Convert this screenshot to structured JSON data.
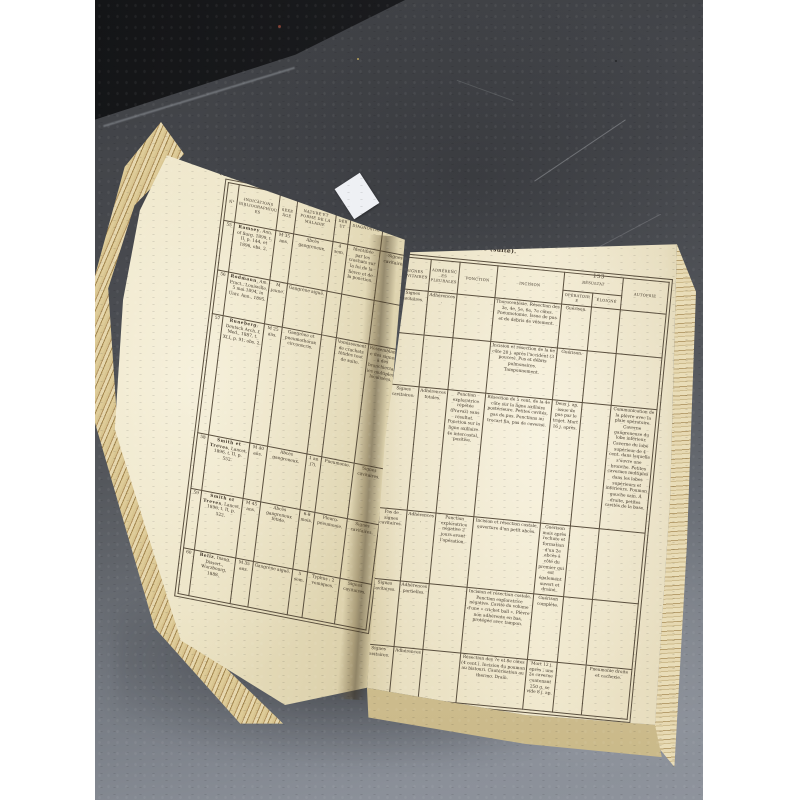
{
  "scene": {
    "description": "Antique medical book lying open on grey tiled floor, photographed from above",
    "colors": {
      "pillarbox": "#ffffff",
      "floor_dark": "#47494e",
      "floor_light": "#8b9099",
      "black_object": "#1b1c1e",
      "page_cream": "#ece3c5",
      "page_edge_tan": "#c9b281",
      "print_ink": "#3c3226",
      "bookmark_white": "#eef0f4"
    }
  },
  "book": {
    "bookmark_label": "",
    "left_page": {
      "page_number": "152",
      "side_label": "Tableau X.",
      "table": {
        "headers": [
          "N°",
          "Indications bibliographiques",
          "Sexe âge",
          "Nature et forme de la maladie",
          "Début",
          "Diagnostic",
          "Signes"
        ],
        "rows": [
          {
            "num": "55",
            "biblio": "Ramsey, Ann. of Surg. 1899, t. II, p. 144, et 1896, obs. 2.",
            "sexe_age": "M 35 ans.",
            "nature": "Abcès gangreneux.",
            "debut": "4 sem.",
            "diagnostic": "Identifiée par les crachats sur la foi de la fièvre et de la ponction.",
            "signes": "Signes cavitaires."
          },
          {
            "num": "56",
            "biblio": "Rodmann, Am. Pract., Louisville, 5 mai 1894, in Univ. Ann., 1895.",
            "sexe_age": "M jeune.",
            "nature": "Gangrène aiguë.",
            "debut": "",
            "diagnostic": "",
            "signes": ""
          },
          {
            "num": "57",
            "biblio": "Runeberg, Deutsch Arch. f. Med., 1887, t. XLI, p. 91, obs. 2.",
            "sexe_age": "M 25 ans.",
            "nature": "Gangrène et pneumothorax circonscris.",
            "debut": "",
            "diagnostic": "Vomissement de crachats fétides tout de suite.",
            "signes": "Ressemblance des signes à des bronchiectasies multiples, localisées."
          },
          {
            "num": "58",
            "biblio": "Smith et Treves, Lancet, 1896, t. II, p. 552.",
            "sexe_age": "M 40 ans.",
            "nature": "Abcès gangreneux.",
            "debut": "1 an (?).",
            "diagnostic": "Pneumonie.",
            "signes": "Signes cavitaires."
          },
          {
            "num": "59",
            "biblio": "Smith et Treves, Lancet, 1896, t. II, p. 522.",
            "sexe_age": "M 45 ans.",
            "nature": "Abcès gangreneux fétide.",
            "debut": "6-8 mois.",
            "diagnostic": "Pleuro-pneumonie.",
            "signes": "Signes cavitaires."
          },
          {
            "num": "60",
            "biblio": "Beliz, Inaug. Dissert., Wurzbourg, 1888.",
            "sexe_age": "M 35 ans.",
            "nature": "Gangrène aiguë.",
            "debut": "5 sem.",
            "diagnostic": "Typhus ; 2 vomiques.",
            "signes": "Signes cavitaires."
          }
        ]
      }
    },
    "right_page": {
      "title": "Gangrène pulmonaire (suite).",
      "page_number": "153",
      "table": {
        "headers": [
          "Signes cavitaires",
          "Adhérences pleurales",
          "Ponction",
          "Incision",
          "Résultat",
          "Autopsie"
        ],
        "resultat_sub": [
          "Opératoire",
          "Éloigné"
        ],
        "rows": [
          {
            "signes": "Signes cavitaires.",
            "adherences": "Adhérences.",
            "ponction": "",
            "incision": "Thoracentésie. Résection des 3e, 4e, 5e, 6e, 7e côtes. Pneumotomie. Issue de pus et de débris de vêtement.",
            "resultat_operatoire": "Guérison.",
            "resultat_eloigne": "",
            "autopsie": ""
          },
          {
            "signes": "",
            "adherences": "",
            "ponction": "",
            "incision": "Incision et résection de la 6e côte 20 j. après l'accident (3 pouces). Pus et débris pulmonaires. Tamponnement.",
            "resultat_operatoire": "Guérison.",
            "resultat_eloigne": "",
            "autopsie": ""
          },
          {
            "signes": "Signes cavitaires.",
            "adherences": "Adhérences totales.",
            "ponction": "Ponction exploratrice répétée (Pravaz) sans résultat. Ponction sur la ligne axillaire 4e intercostal, positive.",
            "incision": "Résection de 5 cent. de la 4e côte sur la ligne axillaire postérieure. Petites cavités, pas de pus. Ponctions au trocart fin, pas de caverne.",
            "resultat_operatoire": "Deux j. ap. issue de pus par le trajet. Mort 16 j. après.",
            "resultat_eloigne": "",
            "autopsie": "Communication de la plèvre avec la plaie opératoire. Caverne gangreneuse du lobe inférieur. Caverne du lobe supérieur de 4 cent. dans laquelle s'ouvre une bronche. Petites cavernes multiples dans les lobes supérieurs et inférieurs. Poumon gauche sain. À droite, petites cavités de la base."
          },
          {
            "signes": "Pas de signes cavitaires.",
            "adherences": "Adhérences.",
            "ponction": "Ponction exploratrice négative 2 jours avant l'opération.",
            "incision": "Incision et résection costale, ouverture d'un petit abcès.",
            "resultat_operatoire": "Guérison mais après rechute et formation d'un 2e abcès à côté du premier qui est également ouvert et drainé.",
            "resultat_eloigne": "",
            "autopsie": ""
          },
          {
            "signes": "Signes cavitaires.",
            "adherences": "Adhérences partielles.",
            "ponction": "",
            "incision": "Incision et résection costale. Ponction exploratrice négative. Cavité du volume d'une « cricket ball ». Plèvre non adhérente en bas, protégée avec tampon.",
            "resultat_operatoire": "Guérison complète.",
            "resultat_eloigne": "",
            "autopsie": ""
          },
          {
            "signes": "Signes cavitaires.",
            "adherences": "Adhérences.",
            "ponction": "",
            "incision": "Résection des 7e et 8e côtes (4 cent.). Incision du poumon au bistouri. Cautérisation au thermo. Drain.",
            "resultat_operatoire": "Mort 12 j. après ; une 2e caverne contenant 250 g. se vide 8 j. ap.",
            "resultat_eloigne": "",
            "autopsie": "Pneumonie droite et cachexie."
          }
        ]
      }
    }
  }
}
